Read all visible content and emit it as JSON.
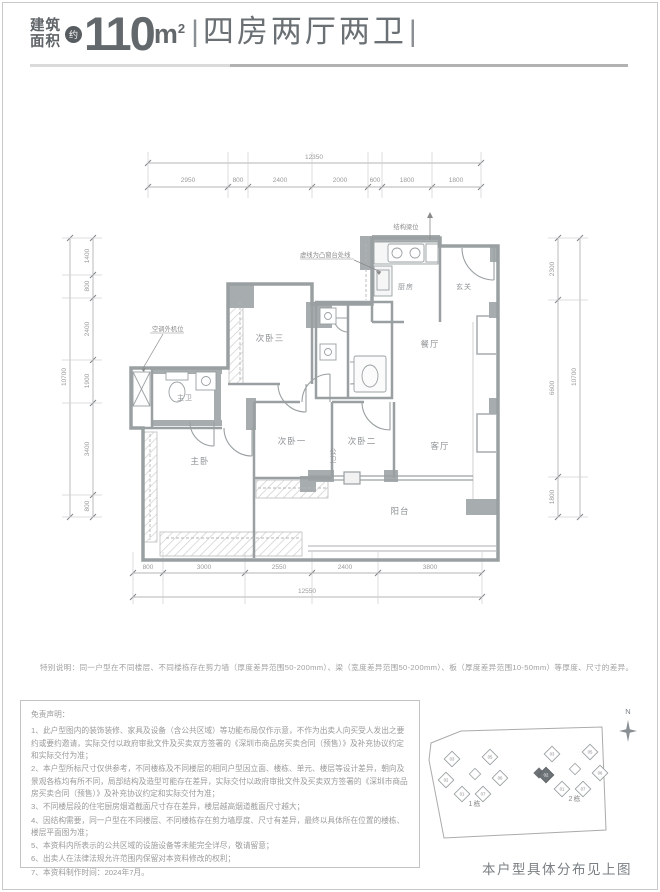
{
  "colors": {
    "accent": "#585d61",
    "wall": "#a7acae",
    "text_dark": "#5f6468",
    "text_gray": "#9a9a9a"
  },
  "header": {
    "area_label_top": "建筑",
    "area_label_bottom": "面积",
    "approx_badge": "约",
    "area_value": "110",
    "area_unit_base": "m",
    "area_unit_sup": "2",
    "pipe_left": "|",
    "layout_text": "四房两厅两卫",
    "pipe_right": "|"
  },
  "floor_plan": {
    "rooms": {
      "kitchen": "厨房",
      "foyer": "玄关",
      "dining": "餐厅",
      "bedroom3": "次卧三",
      "public_bath": "公卫",
      "master_bath": "主卫",
      "master_bedroom": "主卧",
      "bedroom1": "次卧一",
      "bedroom2": "次卧二",
      "living": "客厅",
      "balcony": "阳台"
    },
    "annotations": {
      "ac_unit": "空调外机位",
      "bay_window": "虚线为凸窗台处线",
      "beam": "结构梁位"
    },
    "dims": {
      "top": {
        "total": "12350",
        "segments": [
          "2950",
          "800",
          "2400",
          "2000",
          "600",
          "1800",
          "1800"
        ]
      },
      "bottom": {
        "total": "12550",
        "segments": [
          "800",
          "3000",
          "2550",
          "2400",
          "3800"
        ]
      },
      "left": {
        "total": "10700",
        "segments": [
          "1400",
          "800",
          "2400",
          "1900",
          "3400",
          "800"
        ]
      },
      "right": {
        "total": "10700",
        "segments": [
          "2300",
          "6600",
          "1800"
        ]
      }
    }
  },
  "special_note": "特别说明：同一户型在不同楼层、不同楼栋存在剪力墙（厚度差异范围50-200mm）、梁（宽度差异范围50-200mm）、板（厚度差异范围10-50mm）等厚度、尺寸的差异。",
  "disclaimer": {
    "title": "免责声明：",
    "items": [
      "1、此户型图内的装饰装修、家具及设备（含公共区域）等功能布局仅作示意，不作为出卖人向买受人发出之要约或要约邀请，实际交付以政府审批文件及买卖双方签署的《深圳市商品房买卖合同（预售）》及补充协议约定和实际交付为准；",
      "2、本户型所标尺寸仅供参考，不同楼栋及不同楼层的相同户型因立面、楼栋、单元、楼层等设计差异，朝向及景观各栋均有所不同，局部结构及造型可能存在差异，实际交付以政府审批文件及买卖双方签署的《深圳市商品房买卖合同（预售）》及补充协议约定和实际交付为准；",
      "3、不同楼层段的住宅厨房烟道截面尺寸存在差异，楼层越高烟道截面尺寸越大；",
      "4、因结构需要，同一户型在不同楼层、不同楼栋存在剪力墙厚度、尺寸有差异，最终以具体所在位置的楼栋、楼层平面图为准；",
      "5、本资料内所表示的公共区域的设施设备等未能完全详尽，敬请留意；",
      "6、出卖人在法律法规允许范围内保留对本资料修改的权利；",
      "7、本资料制作时间：2024年7月。"
    ]
  },
  "site_plan": {
    "north_label": "N",
    "building1": {
      "label": "1栋",
      "units": [
        "03",
        "05",
        "02",
        "06",
        "01",
        "07"
      ]
    },
    "building2": {
      "label": "2栋",
      "units": [
        "03",
        "05",
        "02",
        "06",
        "01",
        "07"
      ],
      "highlighted_unit": "02"
    },
    "caption": "本户型具体分布见上图"
  }
}
